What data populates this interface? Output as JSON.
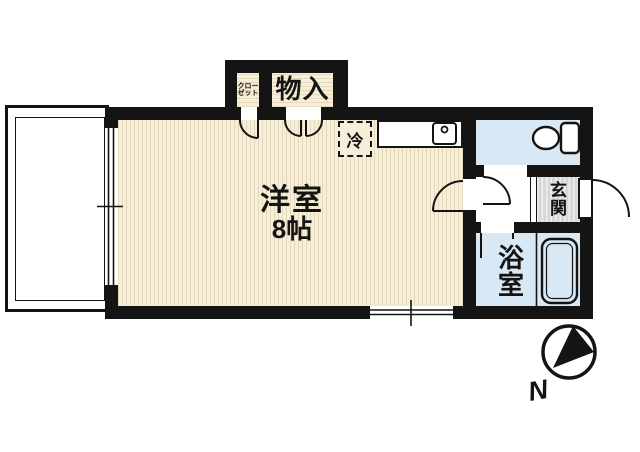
{
  "floorplan": {
    "labels": {
      "room_name": "洋室",
      "room_size": "8帖",
      "closet_lines": [
        "クロー",
        "ゼット"
      ],
      "storage": "物入",
      "fridge": "冷",
      "entrance_chars": [
        "玄",
        "関"
      ],
      "bathroom_chars": [
        "浴",
        "室"
      ],
      "compass_north": "N"
    },
    "colors": {
      "wall": "#141414",
      "floor": "#f7eeda",
      "floor-stripe": "#e6d9bb",
      "water": "#d8e8f4",
      "genkan": "#d7d7d7",
      "genkan-stripe": "#efefef",
      "paper": "#ffffff",
      "line": "#141414"
    }
  }
}
